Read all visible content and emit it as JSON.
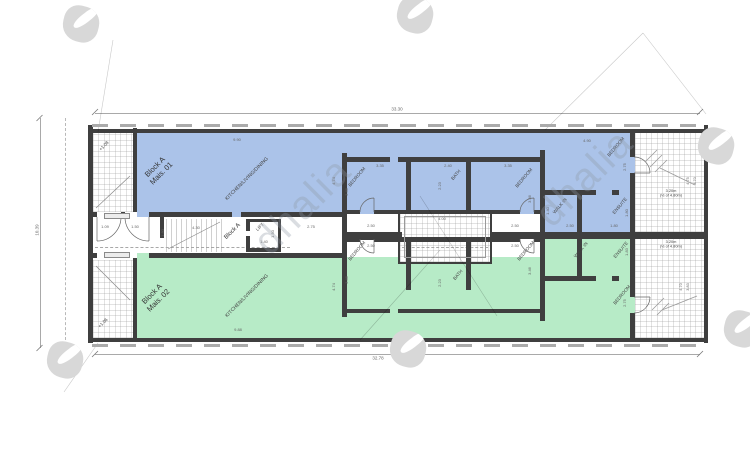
{
  "watermark": {
    "brand": "dhalia",
    "logos": [
      {
        "x": 81,
        "y": 24
      },
      {
        "x": 415,
        "y": 15
      },
      {
        "x": 716,
        "y": 146
      },
      {
        "x": 65,
        "y": 360
      },
      {
        "x": 408,
        "y": 349
      },
      {
        "x": 742,
        "y": 329
      }
    ],
    "texts": [
      {
        "x": 303,
        "y": 206,
        "rot": -45
      },
      {
        "x": 585,
        "y": 178,
        "rot": -45
      }
    ]
  },
  "drawing": {
    "colors": {
      "unit1_fill": "#abc3e9",
      "unit2_fill": "#b7ebc7",
      "walls": "#3f3f3f"
    },
    "overall_dimensions": {
      "top": "33.30",
      "bottom": "32.78",
      "left": "10.39"
    },
    "labels": [
      {
        "name": "unit-1-title",
        "text": "Block A\nMais. 01",
        "x": 158,
        "y": 170,
        "rot": -45,
        "size": 7.5,
        "color": "#333"
      },
      {
        "name": "unit-2-title",
        "text": "Block A\nMais. 02",
        "x": 155,
        "y": 297,
        "rot": -45,
        "size": 7.5,
        "color": "#333"
      },
      {
        "name": "room-kitchen-1",
        "text": "KITCHEN/LIVING/DINING",
        "x": 247,
        "y": 179,
        "rot": -45,
        "size": 5
      },
      {
        "name": "room-kitchen-2",
        "text": "KITCHEN/LIVING/DINING",
        "x": 247,
        "y": 296,
        "rot": -45,
        "size": 5
      },
      {
        "name": "core-title",
        "text": "Block A",
        "x": 233,
        "y": 232,
        "rot": -45,
        "size": 6,
        "color": "#333"
      },
      {
        "name": "room-lift",
        "text": "LIFT",
        "x": 260,
        "y": 227,
        "rot": -45,
        "size": 4.5
      },
      {
        "name": "room-bedroom",
        "text": "BEDROOM",
        "x": 357,
        "y": 177,
        "rot": -50,
        "size": 4.6
      },
      {
        "name": "room-bedroom",
        "text": "BEDROOM",
        "x": 524,
        "y": 178,
        "rot": -50,
        "size": 4.6
      },
      {
        "name": "room-bedroom",
        "text": "BEDROOM",
        "x": 616,
        "y": 147,
        "rot": -50,
        "size": 4.6
      },
      {
        "name": "room-bath",
        "text": "BATH",
        "x": 456,
        "y": 175,
        "rot": -50,
        "size": 4.6
      },
      {
        "name": "room-walkin",
        "text": "WALK IN",
        "x": 560,
        "y": 206,
        "rot": -50,
        "size": 4.6
      },
      {
        "name": "room-ensuite",
        "text": "ENSUITE",
        "x": 620,
        "y": 206,
        "rot": -50,
        "size": 4.6
      },
      {
        "name": "room-bedroom",
        "text": "BEDROOM",
        "x": 357,
        "y": 251,
        "rot": -50,
        "size": 4.6
      },
      {
        "name": "room-bedroom",
        "text": "BEDROOM",
        "x": 526,
        "y": 251,
        "rot": -50,
        "size": 4.6
      },
      {
        "name": "room-bedroom",
        "text": "BEDROOM",
        "x": 622,
        "y": 295,
        "rot": -50,
        "size": 4.6
      },
      {
        "name": "room-bath",
        "text": "BATH",
        "x": 458,
        "y": 275,
        "rot": -50,
        "size": 4.6
      },
      {
        "name": "room-walkin",
        "text": "WALK IN",
        "x": 581,
        "y": 250,
        "rot": -50,
        "size": 4.6
      },
      {
        "name": "room-ensuite",
        "text": "ENSUITE",
        "x": 621,
        "y": 250,
        "rot": -50,
        "size": 4.6
      },
      {
        "name": "level-note",
        "text": "+1.08",
        "x": 104,
        "y": 146,
        "rot": -45,
        "size": 4.5
      },
      {
        "name": "level-note",
        "text": "+1.06",
        "x": 103,
        "y": 323,
        "rot": -45,
        "size": 4.5
      },
      {
        "name": "terrace-note",
        "text": "3.20m\n(½ of 4.80m)",
        "x": 671,
        "y": 193,
        "rot": 0,
        "size": 3.9
      },
      {
        "name": "terrace-note",
        "text": "3.20m\n(½ of 4.80m)",
        "x": 671,
        "y": 244,
        "rot": 0,
        "size": 3.9
      },
      {
        "name": "overall-dim",
        "text": "33.30",
        "x": 397,
        "y": 109,
        "rot": 0,
        "size": 4.5,
        "color": "#666"
      },
      {
        "name": "overall-dim",
        "text": "32.78",
        "x": 378,
        "y": 358,
        "rot": 0,
        "size": 4.5,
        "color": "#666"
      },
      {
        "name": "overall-dim",
        "text": "10.39",
        "x": 36.5,
        "y": 230,
        "rot": -90,
        "size": 4.5,
        "color": "#666"
      },
      {
        "name": "dim",
        "text": "9.90",
        "x": 237,
        "y": 140,
        "rot": 0,
        "size": 4,
        "color": "#666"
      },
      {
        "name": "dim",
        "text": "4.90",
        "x": 587,
        "y": 141,
        "rot": 0,
        "size": 4,
        "color": "#666"
      },
      {
        "name": "dim",
        "text": "3.35",
        "x": 380,
        "y": 166,
        "rot": 0,
        "size": 4,
        "color": "#666"
      },
      {
        "name": "dim",
        "text": "2.40",
        "x": 448,
        "y": 166,
        "rot": 0,
        "size": 4,
        "color": "#666"
      },
      {
        "name": "dim",
        "text": "3.35",
        "x": 508,
        "y": 166,
        "rot": 0,
        "size": 4,
        "color": "#666"
      },
      {
        "name": "dim",
        "text": "2.50",
        "x": 371,
        "y": 226,
        "rot": 0,
        "size": 4,
        "color": "#666"
      },
      {
        "name": "dim",
        "text": "2.50",
        "x": 515,
        "y": 226,
        "rot": 0,
        "size": 4,
        "color": "#666"
      },
      {
        "name": "dim",
        "text": "2.50",
        "x": 570,
        "y": 226,
        "rot": 0,
        "size": 4,
        "color": "#666"
      },
      {
        "name": "dim",
        "text": "1.80",
        "x": 614,
        "y": 226,
        "rot": 0,
        "size": 4,
        "color": "#666"
      },
      {
        "name": "dim",
        "text": "4.00",
        "x": 442,
        "y": 219,
        "rot": 0,
        "size": 4,
        "color": "#666"
      },
      {
        "name": "dim",
        "text": "1.09",
        "x": 105,
        "y": 227,
        "rot": 0,
        "size": 4,
        "color": "#666"
      },
      {
        "name": "dim",
        "text": "1.50",
        "x": 135,
        "y": 227,
        "rot": 0,
        "size": 4,
        "color": "#666"
      },
      {
        "name": "dim",
        "text": "4.30",
        "x": 196,
        "y": 228,
        "rot": 0,
        "size": 4,
        "color": "#666"
      },
      {
        "name": "dim",
        "text": "1.40",
        "x": 264,
        "y": 242,
        "rot": 0,
        "size": 4,
        "color": "#666"
      },
      {
        "name": "dim",
        "text": "2.75",
        "x": 311,
        "y": 227,
        "rot": 0,
        "size": 4,
        "color": "#666"
      },
      {
        "name": "dim",
        "text": "9.88",
        "x": 238,
        "y": 330,
        "rot": 0,
        "size": 4,
        "color": "#666"
      },
      {
        "name": "dim",
        "text": "2.50",
        "x": 371,
        "y": 246,
        "rot": 0,
        "size": 4,
        "color": "#666"
      },
      {
        "name": "dim",
        "text": "2.50",
        "x": 515,
        "y": 246,
        "rot": 0,
        "size": 4,
        "color": "#666"
      },
      {
        "name": "dim",
        "text": "4.74",
        "x": 334,
        "y": 181,
        "rot": -90,
        "size": 4,
        "color": "#666"
      },
      {
        "name": "dim",
        "text": "4.74",
        "x": 334,
        "y": 287,
        "rot": -90,
        "size": 4,
        "color": "#666"
      },
      {
        "name": "dim",
        "text": "3.46",
        "x": 347,
        "y": 192,
        "rot": -90,
        "size": 4,
        "color": "#666"
      },
      {
        "name": "dim",
        "text": "3.46",
        "x": 347,
        "y": 280,
        "rot": -90,
        "size": 4,
        "color": "#666"
      },
      {
        "name": "dim",
        "text": "2.23",
        "x": 440,
        "y": 186,
        "rot": -90,
        "size": 4,
        "color": "#666"
      },
      {
        "name": "dim",
        "text": "2.23",
        "x": 440,
        "y": 283,
        "rot": -90,
        "size": 4,
        "color": "#666"
      },
      {
        "name": "dim",
        "text": "2.75",
        "x": 625,
        "y": 167,
        "rot": -90,
        "size": 4,
        "color": "#666"
      },
      {
        "name": "dim",
        "text": "2.75",
        "x": 625,
        "y": 303,
        "rot": -90,
        "size": 4,
        "color": "#666"
      },
      {
        "name": "dim",
        "text": "1.80",
        "x": 163,
        "y": 233,
        "rot": -90,
        "size": 4,
        "color": "#666"
      },
      {
        "name": "dim",
        "text": "1.50",
        "x": 273,
        "y": 234,
        "rot": -90,
        "size": 4,
        "color": "#666"
      },
      {
        "name": "dim",
        "text": "1.40",
        "x": 548,
        "y": 211,
        "rot": -90,
        "size": 4,
        "color": "#666"
      },
      {
        "name": "dim",
        "text": "1.80",
        "x": 627,
        "y": 213,
        "rot": -90,
        "size": 4,
        "color": "#666"
      },
      {
        "name": "dim",
        "text": "1.83",
        "x": 627,
        "y": 252,
        "rot": -90,
        "size": 4,
        "color": "#666"
      },
      {
        "name": "dim",
        "text": "3.46",
        "x": 530,
        "y": 199,
        "rot": -90,
        "size": 4,
        "color": "#666"
      },
      {
        "name": "dim",
        "text": "3.46",
        "x": 530,
        "y": 271,
        "rot": -90,
        "size": 4,
        "color": "#666"
      },
      {
        "name": "dim",
        "text": "4.75",
        "x": 688,
        "y": 181,
        "rot": -90,
        "size": 3.8,
        "color": "#666"
      },
      {
        "name": "dim",
        "text": "3.70",
        "x": 695,
        "y": 181,
        "rot": -90,
        "size": 3.8,
        "color": "#666"
      },
      {
        "name": "dim",
        "text": "4.70",
        "x": 681,
        "y": 287,
        "rot": -90,
        "size": 3.8,
        "color": "#666"
      },
      {
        "name": "dim",
        "text": "3.83",
        "x": 688,
        "y": 287,
        "rot": -90,
        "size": 3.8,
        "color": "#666"
      }
    ]
  }
}
